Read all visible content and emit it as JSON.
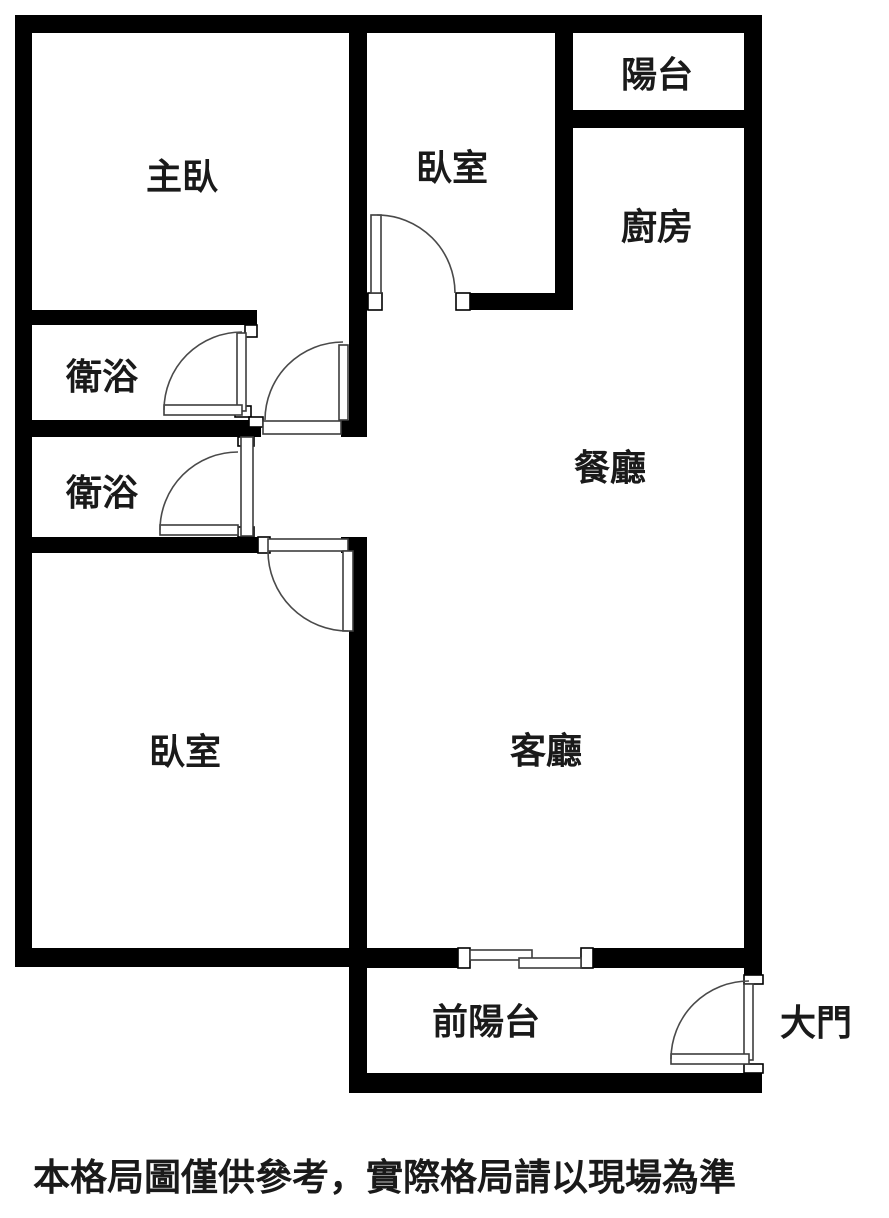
{
  "plan_title": "apartment-floor-plan",
  "rooms": {
    "master_bedroom": {
      "label": "主臥"
    },
    "bedroom_top": {
      "label": "臥室"
    },
    "balcony_top": {
      "label": "陽台"
    },
    "kitchen": {
      "label": "廚房"
    },
    "bathroom_upper": {
      "label": "衛浴"
    },
    "bathroom_lower": {
      "label": "衛浴"
    },
    "dining_room": {
      "label": "餐廳"
    },
    "living_room": {
      "label": "客廳"
    },
    "bedroom_bottom": {
      "label": "臥室"
    },
    "front_balcony": {
      "label": "前陽台"
    },
    "main_door": {
      "label": "大門"
    }
  },
  "disclaimer": "本格局圖僅供參考，實際格局請以現場為準",
  "features": [
    "swing-door-bedroom-top",
    "swing-door-bathroom-upper",
    "swing-door-upper-hallway",
    "swing-door-bathroom-lower",
    "swing-door-bedroom-bottom",
    "swing-door-main-entrance",
    "sliding-door-front-balcony"
  ],
  "colors": {
    "wall": "#000000",
    "door_line": "#3d3d3d",
    "background": "#ffffff",
    "text": "#1a1a1a"
  }
}
